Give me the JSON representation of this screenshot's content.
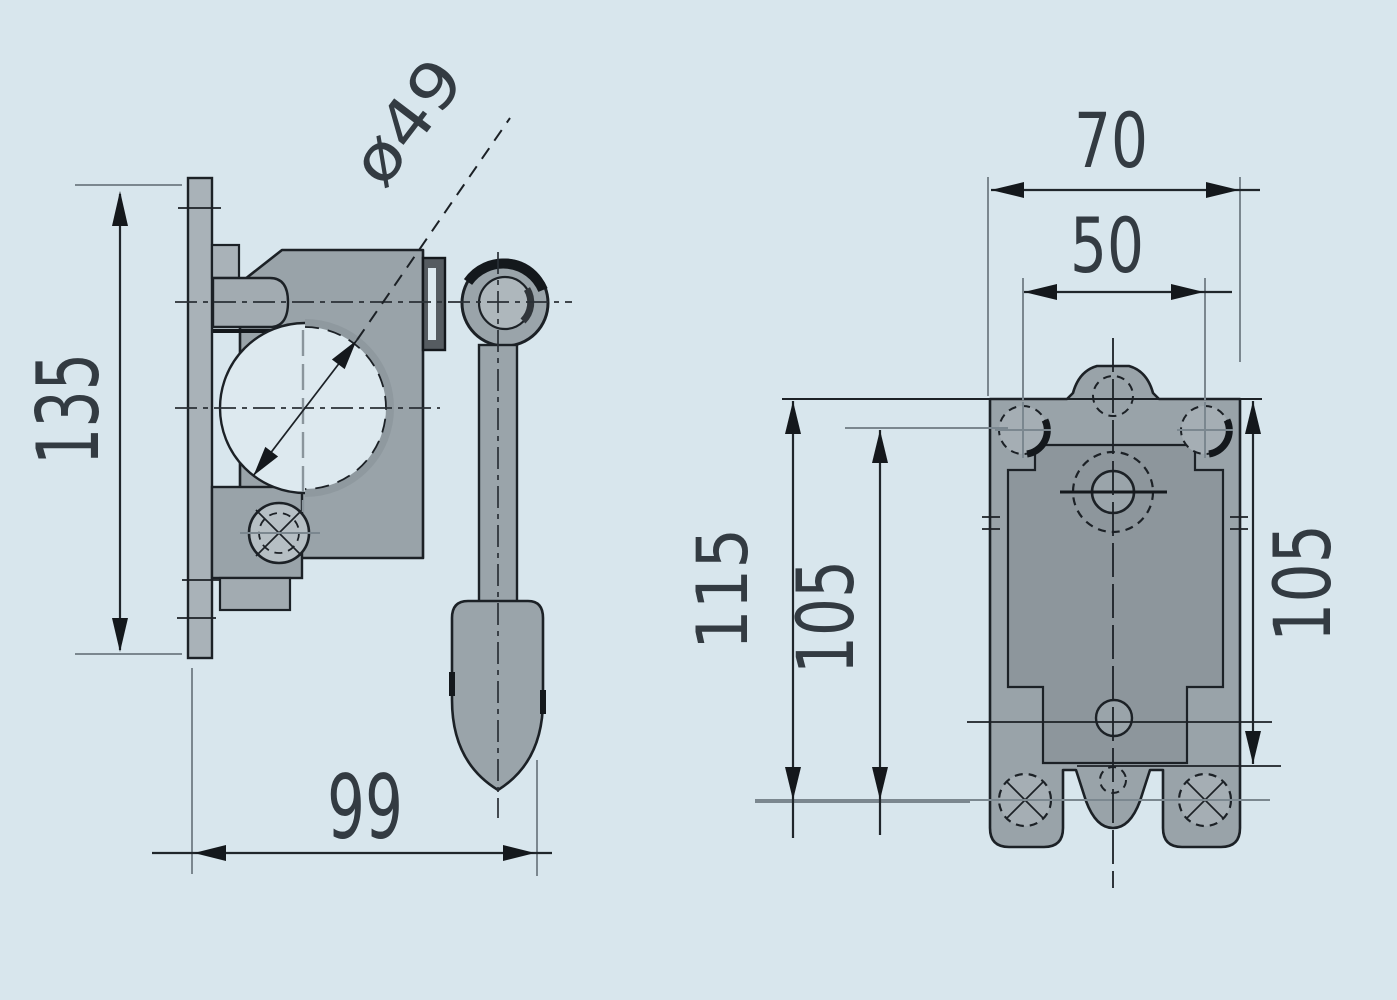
{
  "drawing": {
    "background_color": "#d8e6ed",
    "part_color": "#99a3a9",
    "recess_color": "#8d969c",
    "line_color": "#1c2126",
    "views": {
      "side": {
        "dimensions": {
          "height": "135",
          "width": "99",
          "bore_diameter": "ø49"
        }
      },
      "front": {
        "dimensions": {
          "overall_width": "70",
          "hole_spacing_width": "50",
          "edge_to_hole_height": "115",
          "hole_spacing_height": "105",
          "right_height": "105"
        }
      }
    }
  }
}
